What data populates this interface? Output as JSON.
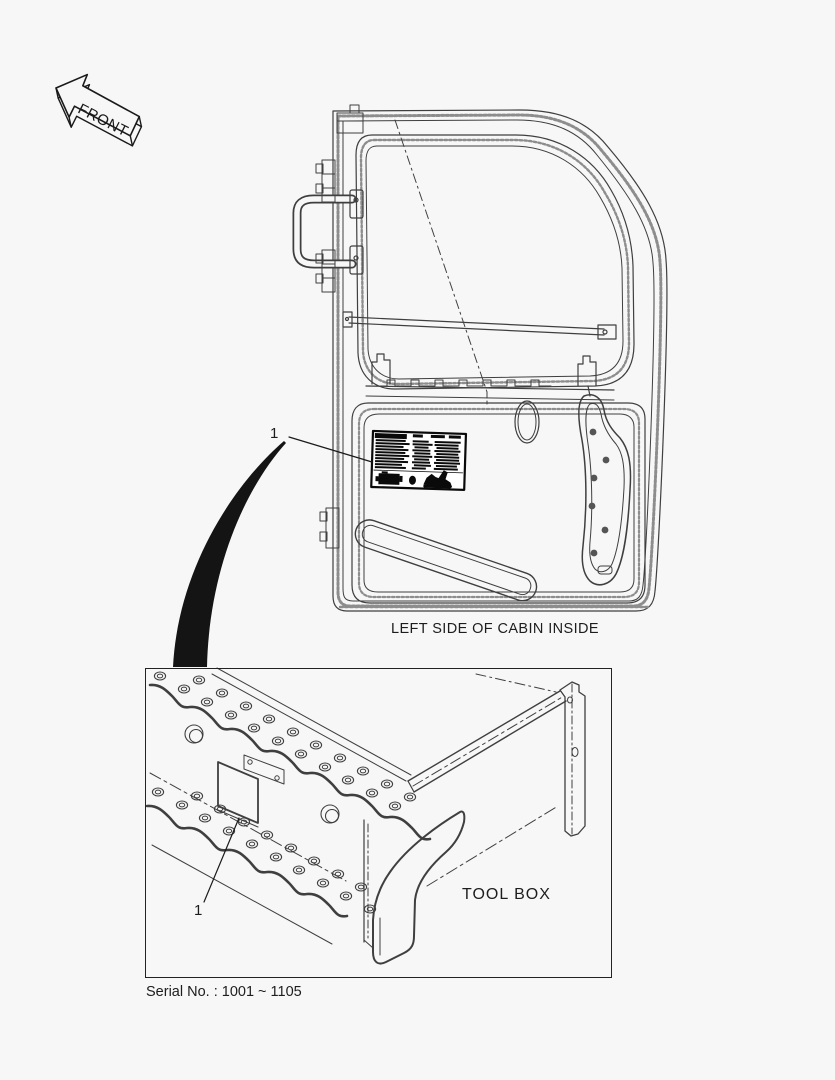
{
  "page": {
    "background": "#f7f7f8",
    "line_color": "#3f3f3f",
    "ink_color": "#151515"
  },
  "front_arrow": {
    "label": "FRONT"
  },
  "door_view": {
    "caption": "LEFT SIDE OF CABIN INSIDE",
    "callout": "1",
    "decal_icon": "specification-decal-icon"
  },
  "detail_view": {
    "label": "TOOL BOX",
    "callout": "1",
    "plate_icon": "decal-plate-icon"
  },
  "footer": {
    "serial_note": "Serial No. : 1001 ~ 1105"
  }
}
